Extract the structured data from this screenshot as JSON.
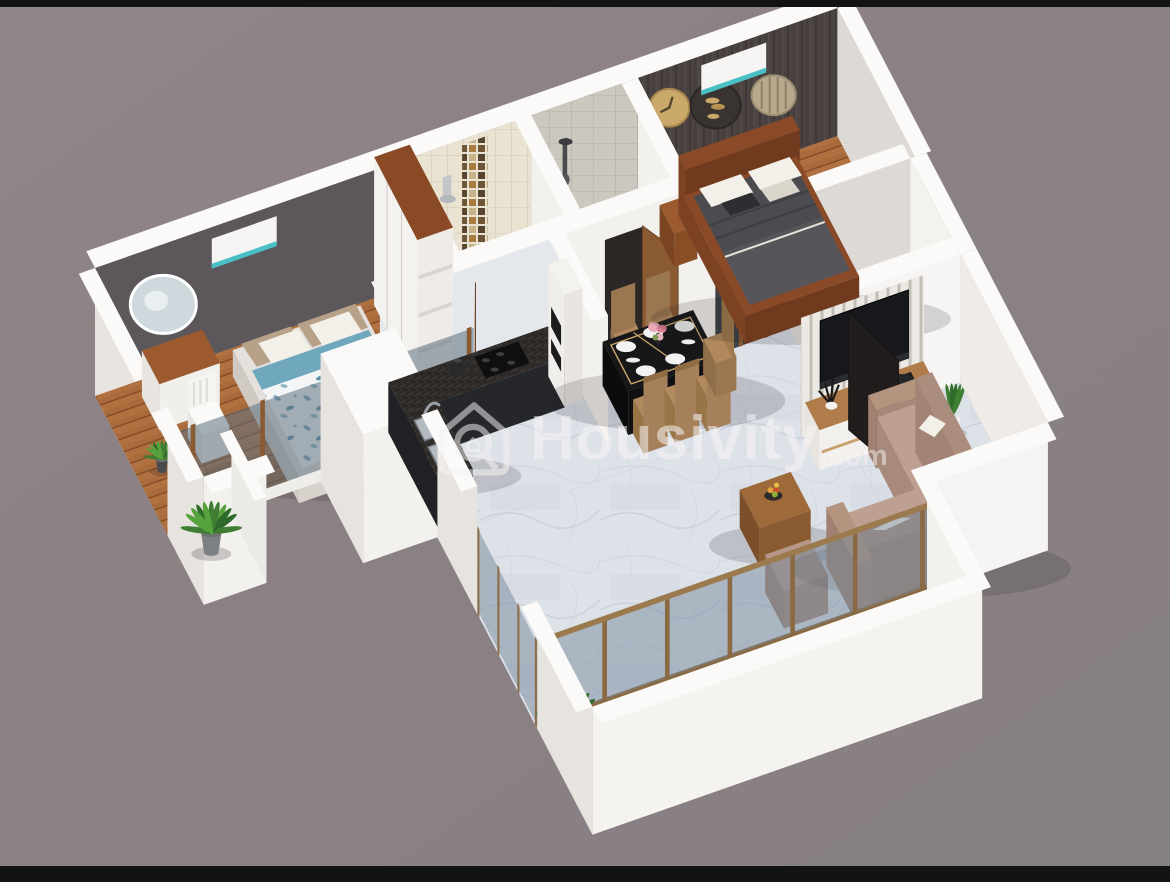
{
  "watermark": {
    "brand": "Housivity",
    "suffix": ".com",
    "logo": "house-magnifier-logo"
  },
  "scene": {
    "type": "3d-floor-plan-render",
    "view": "isometric dollhouse cutaway of a 2BHK apartment",
    "rooms": [
      {
        "name": "bedroom-1",
        "floor": "wood-plank",
        "furniture": [
          "double-bed-blue-patterned-bedding",
          "white-wardrobe-wood-top",
          "dressing-table",
          "white-chair",
          "round-wall-mirror",
          "air-conditioner",
          "window-ledge-plant"
        ]
      },
      {
        "name": "bathroom-1",
        "floor": "tile",
        "furniture": [
          "toilet",
          "shower-head",
          "mosaic-accent-strip",
          "wooden-door"
        ]
      },
      {
        "name": "bathroom-2",
        "floor": "gray-tile",
        "furniture": [
          "shower-set",
          "vanity-block",
          "wooden-door"
        ]
      },
      {
        "name": "master-bedroom",
        "floor": "wood-plank",
        "furniture": [
          "wooden-double-bed-dark-bedding",
          "bedside-table",
          "air-conditioner",
          "gold-wall-clock",
          "round-wall-decor",
          "slatted-round-mirror",
          "sliding-glass-window"
        ]
      },
      {
        "name": "kitchen",
        "floor": "marble",
        "furniture": [
          "l-shaped-granite-counter",
          "double-steel-sink",
          "black-hob",
          "kettle",
          "tall-oven-unit"
        ]
      },
      {
        "name": "dining-area",
        "floor": "marble",
        "furniture": [
          "black-gold-dining-table",
          "tan-chairs",
          "white-plates",
          "pink-flower-vase"
        ]
      },
      {
        "name": "living-room",
        "floor": "marble",
        "furniture": [
          "l-shaped-beige-sofa",
          "ottoman",
          "wooden-coffee-table",
          "fruit-bowl",
          "tv-console",
          "television",
          "slatted-tv-panel",
          "snake-plant",
          "leaning-dark-door-panel"
        ]
      },
      {
        "name": "utility-room",
        "floor": "plain",
        "furniture": []
      },
      {
        "name": "balcony",
        "floor": "wood-deck",
        "furniture": [
          "glass-railing-bronze-posts",
          "potted-plants"
        ]
      }
    ]
  },
  "colors": {
    "background": "#8b8184",
    "frame_bar": "#141313",
    "wall_white": "#f3f1ee",
    "wall_band": "#fbfaf8",
    "wall_side": "#e7e3df",
    "wall_inner": "#ddd9d4",
    "accent_wall_gray": "#5b575b",
    "accent_wall_dark": "#4a4341",
    "tile_cream": "#eae3d1",
    "tile_gray": "#cbc8c0",
    "wood_floor": "#a96a3c",
    "deck_wood": "#9c5c33",
    "marble": "#dde1e8",
    "granite": "#2e2b29",
    "cabinet_dark": "#25272b",
    "glass": "#76879a",
    "bronze": "#8a6a42",
    "sofa_tan": "#b5988a",
    "sofa_shade": "#a68879",
    "pillow_white": "#f3f0e9",
    "table_black": "#17171a",
    "chair_tan": "#b08a5e",
    "gold": "#c9a86a",
    "teal": "#49c0c4",
    "tv_black": "#17181c",
    "wood_furniture": "#9c5a2e",
    "wood_door": "#8a5a33",
    "bed_blue": "#6fa7bd",
    "bedding_dark": "#4b4b50",
    "plant_green": "#3f7d33",
    "plant_green2": "#56a33e",
    "pot_gray": "#7d8083",
    "watermark_text": "#f7f4f4"
  }
}
